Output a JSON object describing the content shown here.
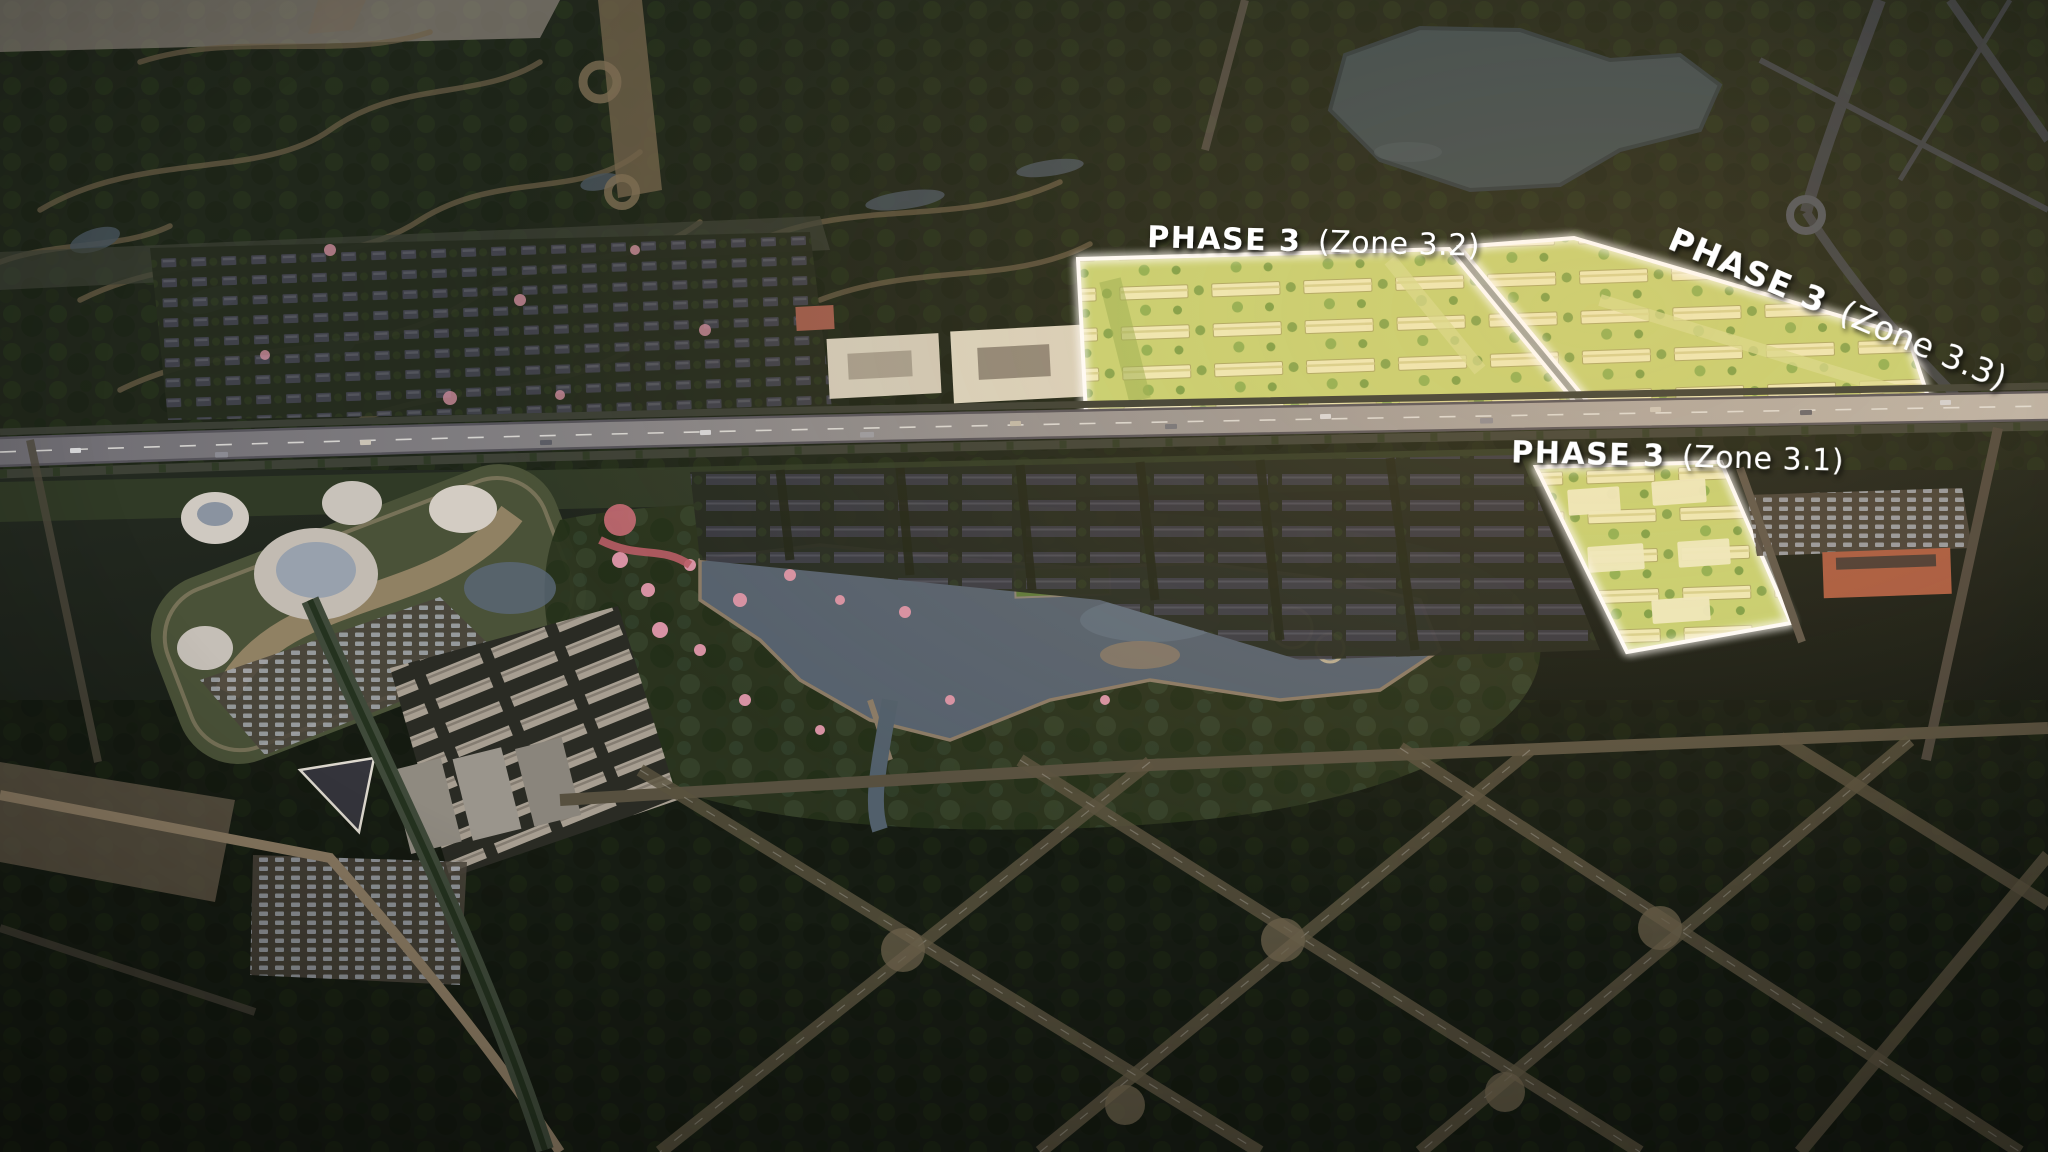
{
  "scene": {
    "annotations": {
      "zone_3_2": {
        "phase_label": "PHASE 3",
        "zone_label": "(Zone 3.2)"
      },
      "zone_3_3": {
        "phase_label": "PHASE 3",
        "zone_label": "(Zone 3.3)"
      },
      "zone_3_1": {
        "phase_label": "PHASE 3",
        "zone_label": "(Zone 3.1)"
      }
    },
    "colors": {
      "highlight_fill": "#c7d172",
      "highlight_building": "#efeab6",
      "highlight_border": "#ffffff",
      "label_text": "#ffffff",
      "expressway_grey": "#a39e97",
      "forest_dark": "#1e2518",
      "lake_teal": "#3c4a4e",
      "lagoon_blue": "#55616e",
      "blossom_pink": "#d792a4",
      "mall_roof_green": "#4a5238",
      "mall_dome_grey": "#cfc9c1",
      "school_orange": "#a85a40",
      "road_tan": "#6b5e47"
    }
  }
}
